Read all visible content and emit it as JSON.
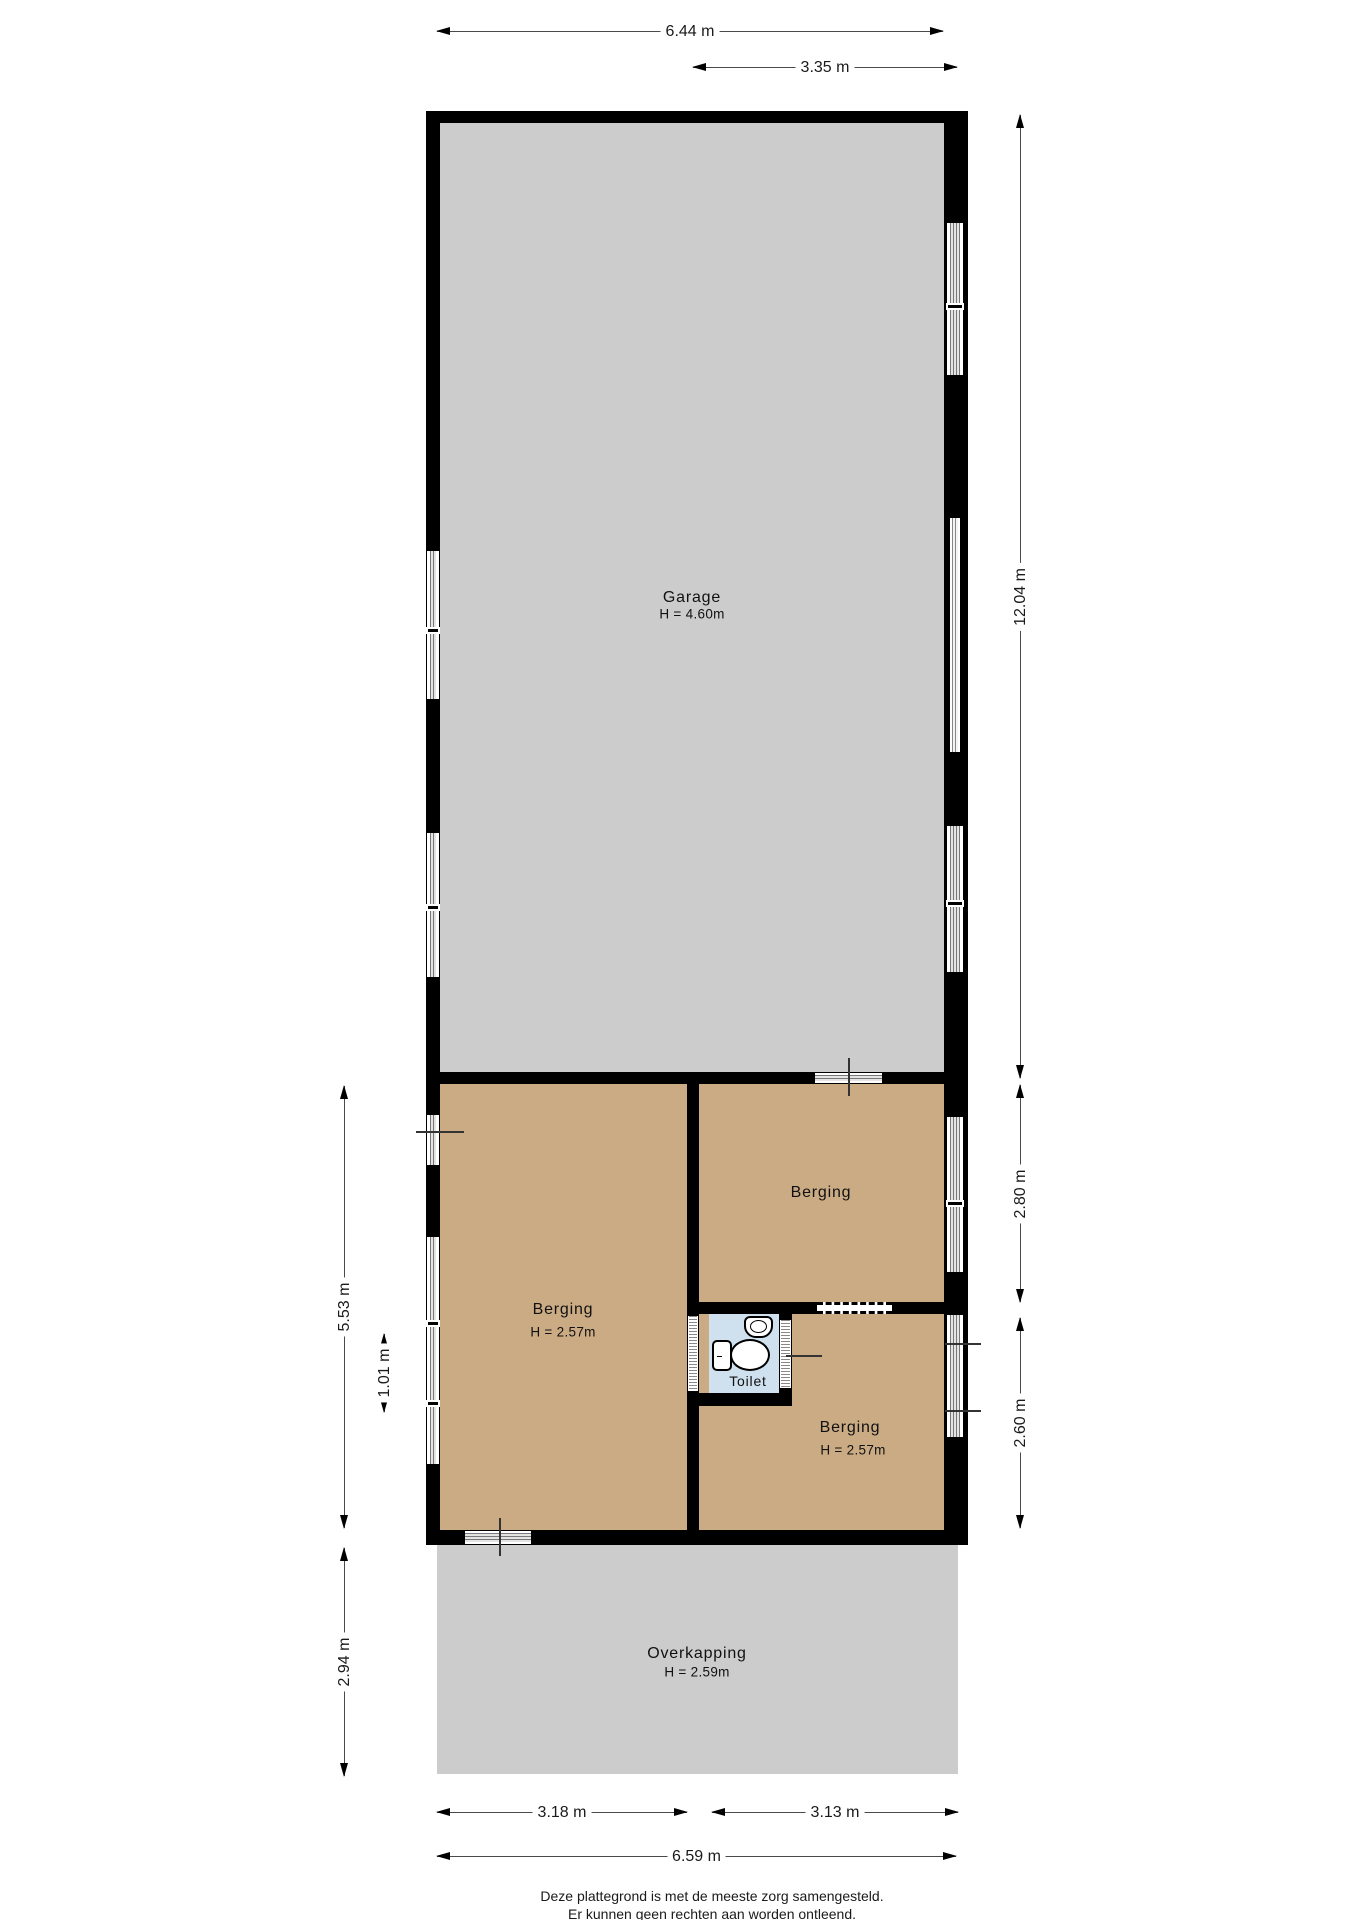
{
  "title": "Plattegrond begane grond - garage met bergingen",
  "rooms": {
    "garage": {
      "name": "Garage",
      "height_label": "H = 4.60m"
    },
    "berging_left": {
      "name": "Berging",
      "height_label": "H = 2.57m"
    },
    "berging_top_right": {
      "name": "Berging"
    },
    "toilet": {
      "name": "Toilet"
    },
    "berging_bottom_right": {
      "name": "Berging",
      "height_label": "H = 2.57m"
    },
    "overkapping": {
      "name": "Overkapping",
      "height_label": "H = 2.59m"
    }
  },
  "dimensions": {
    "top_total_width": "6.44 m",
    "top_partial_width": "3.35 m",
    "right_garage_height": "12.04 m",
    "right_berging_top_height": "2.80 m",
    "right_berging_bottom_height": "2.60 m",
    "left_berging_height": "5.53 m",
    "left_window_pane": "1.01 m",
    "left_overkapping_height": "2.94 m",
    "bottom_left_width": "3.18 m",
    "bottom_right_width": "3.13 m",
    "bottom_total_width": "6.59 m"
  },
  "footer": {
    "line1": "Deze plattegrond is met de meeste zorg samengesteld.",
    "line2": "Er kunnen geen rechten aan worden ontleend."
  },
  "colors": {
    "floor_gray": "#cccccc",
    "floor_tan": "#cbab84",
    "floor_toilet_blue": "#cfe0ee",
    "wall_black": "#000000",
    "background": "#ffffff"
  }
}
